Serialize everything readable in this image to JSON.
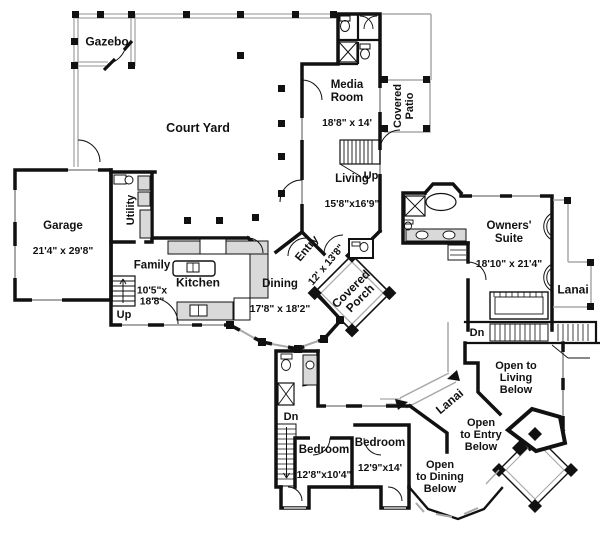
{
  "colors": {
    "wall": "#111111",
    "roof_gray": "#a8a8a8"
  },
  "rooms": {
    "gazebo": {
      "name": "Gazebo"
    },
    "court_yard": {
      "name": "Court Yard"
    },
    "media_room": {
      "name": "Media\nRoom",
      "dims": "18'8\" x 14'"
    },
    "covered_patio": {
      "name": "Covered\nPatio"
    },
    "living": {
      "name": "Living",
      "dims": "15'8\"x16'9\""
    },
    "garage": {
      "name": "Garage",
      "dims": "21'4\" x 29'8\""
    },
    "utility": {
      "name": "Utility"
    },
    "family": {
      "name": "Family",
      "dims": "10'5\"x\n18'8\""
    },
    "kitchen": {
      "name": "Kitchen"
    },
    "dining": {
      "name": "Dining",
      "dims": "17'8\" x 18'2\""
    },
    "entry": {
      "name": "Entry",
      "dims": "12' x 13'8\""
    },
    "covered_porch": {
      "name": "Covered\nPorch"
    },
    "owners_suite": {
      "name": "Owners'\nSuite",
      "dims": "18'10\" x 21'4\""
    },
    "lanai_upper": {
      "name": "Lanai"
    },
    "lanai_walkway": {
      "name": "Lanai"
    },
    "open_living": {
      "name": "Open to\nLiving\nBelow"
    },
    "open_entry": {
      "name": "Open\nto Entry\nBelow"
    },
    "open_dining": {
      "name": "Open\nto Dining\nBelow"
    },
    "bedroom_1": {
      "name": "Bedroom",
      "dims": "12'8\"x10'4\""
    },
    "bedroom_2": {
      "name": "Bedroom",
      "dims": "12'9\"x14'"
    }
  },
  "annotations": {
    "up_stairs_main": "Up",
    "up_stairs_family": "Up",
    "dn_stairs_suite": "Dn",
    "dn_stairs_bedroom": "Dn"
  }
}
